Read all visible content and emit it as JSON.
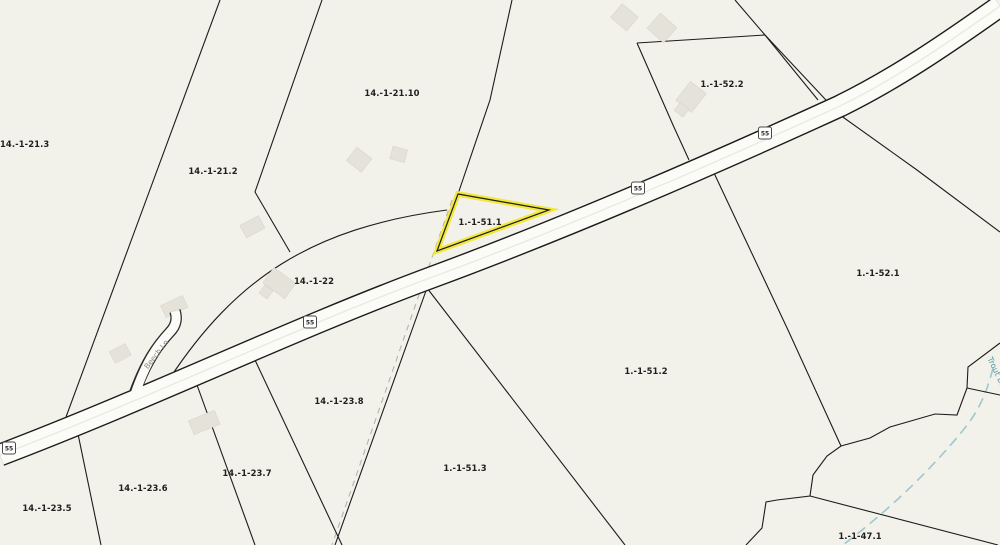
{
  "map": {
    "selected_parcel_id": "1.-1-51.1",
    "parcel_labels": [
      "14.-1-21.3",
      "14.-1-21.2",
      "14.-1-21.10",
      "1.-1-52.2",
      "14.-1-22",
      "1.-1-51.1",
      "1.-1-52.1",
      "1.-1-51.2",
      "14.-1-23.8",
      "1.-1-51.3",
      "14.-1-23.7",
      "14.-1-23.6",
      "14.-1-23.5",
      "1.-1-47.1"
    ],
    "road_shield_number": "55",
    "road_names": [
      "Beech Ln"
    ],
    "water_names": [
      "Trout Bk"
    ],
    "colors": {
      "background": "#f2f1ea",
      "highlight_outline": "#f1e83b",
      "parcel_boundary": "#1c1c1c",
      "road_fill": "#fbfbf8",
      "water": "#9cc8d0",
      "building": "#e4e2d9"
    }
  }
}
